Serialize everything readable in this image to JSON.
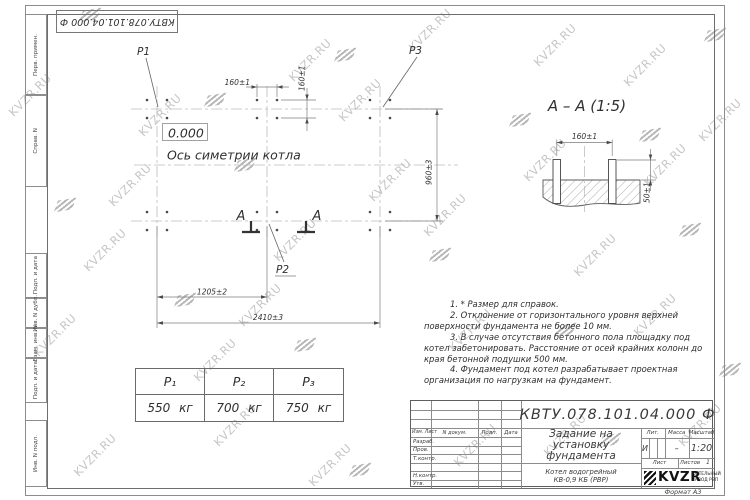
{
  "watermark": {
    "text": "KVZR.RU"
  },
  "stamp_top_left": {
    "doc_number": "КВТУ.078.101.04.000 Ф"
  },
  "side_strip": {
    "labels": [
      "Перв. примен.",
      "Справ. N",
      "Подп. и дата",
      "Инв. N дубл.",
      "Взам. инв. N",
      "Подп. и дата",
      "Инв. N подл."
    ]
  },
  "plan": {
    "level_mark": "0.000",
    "axis_label": "Ось симетрии котла",
    "labels": {
      "p1": "P1",
      "p2": "P2",
      "p3": "P3"
    },
    "section_letter": "А",
    "dims": {
      "d160h": "160±1",
      "d160v": "160±1",
      "d960": "960±3",
      "d1205": "1205±2",
      "d2410": "2410±3"
    }
  },
  "section_view": {
    "title": "А – А (1:5)",
    "dims": {
      "d160": "160±1",
      "d50": "50±1"
    }
  },
  "notes": [
    "1. * Размер для справок.",
    "2. Отклонение от горизонтального уровня верхней поверхности фундамента не более 10 мм.",
    "3. В случае отсутствия бетонного пола площадку под котел забетонировать. Расстояние от осей крайних колонн до края бетонной подушки 500 мм.",
    "4. Фундамент под котел разрабатывает проектная организация по нагрузкам на фундамент."
  ],
  "loads_table": {
    "headers": [
      "P₁",
      "P₂",
      "P₃"
    ],
    "values": [
      "550 кг",
      "700 кг",
      "750 кг"
    ]
  },
  "title_block": {
    "doc_number": "КВТУ.078.101.04.000 Ф",
    "title_lines": [
      "Задание на",
      "установку",
      "фундамента"
    ],
    "product_lines": [
      "Котел водогрейный",
      "КВ-0,9 КБ (РВР)"
    ],
    "header_cols": [
      "Изм. Лист",
      "N докум.",
      "Подп.",
      "Дата"
    ],
    "row_labels": [
      "Разраб.",
      "Пров.",
      "Т.контр.",
      "Н.контр.",
      "Утв."
    ],
    "lit_label": "Лит.",
    "mass_label": "Масса",
    "scale_label": "Масштаб",
    "lit_value": "И",
    "mass_value": "–",
    "scale_value": "1:20",
    "sheet_label": "Лист",
    "sheets_label": "Листов",
    "sheets_value": "1",
    "logo_text": "KVZR",
    "company_lines": [
      "КОТЕЛЬНЫЙ",
      "ЗАВОД РЭП"
    ],
    "format_label": "Формат А3"
  }
}
